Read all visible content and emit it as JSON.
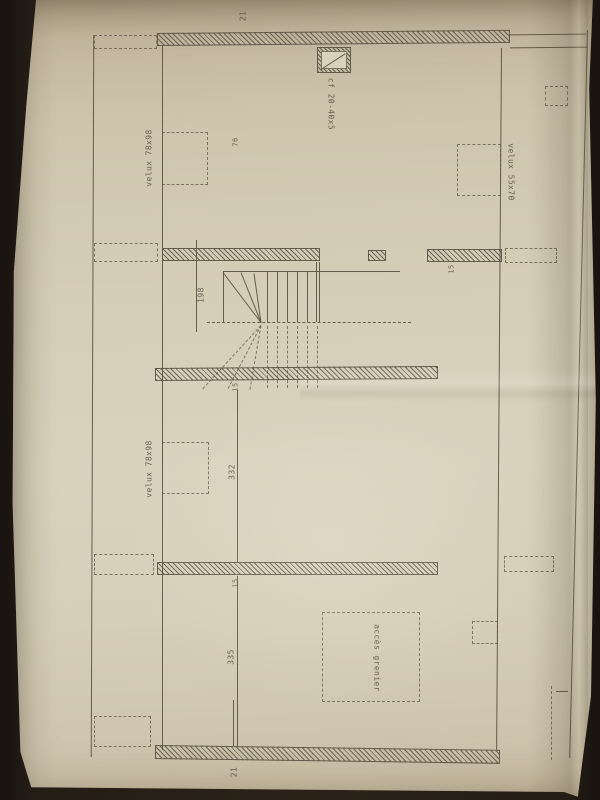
{
  "palette": {
    "paper_color": "#d7ceb8",
    "ink_color": "#5f5646",
    "background_color": "#241d15"
  },
  "plan": {
    "labels": {
      "top_wall_thickness": "21",
      "bottom_wall_thickness": "21",
      "velux_top_left": "velux 78x98",
      "velux_mid_left": "velux 78x98",
      "velux_top_right": "velux 55x70",
      "chimney_flue": "cf 20-40x5",
      "top_room_dim": "76",
      "stair_dim": "198",
      "mid_room_dim": "332",
      "bottom_room_dim": "335",
      "wall_thickness_right": "15",
      "wall_thickness_mid": "15",
      "wall_thickness_lower": "15",
      "attic_access": "accès grenier"
    }
  }
}
